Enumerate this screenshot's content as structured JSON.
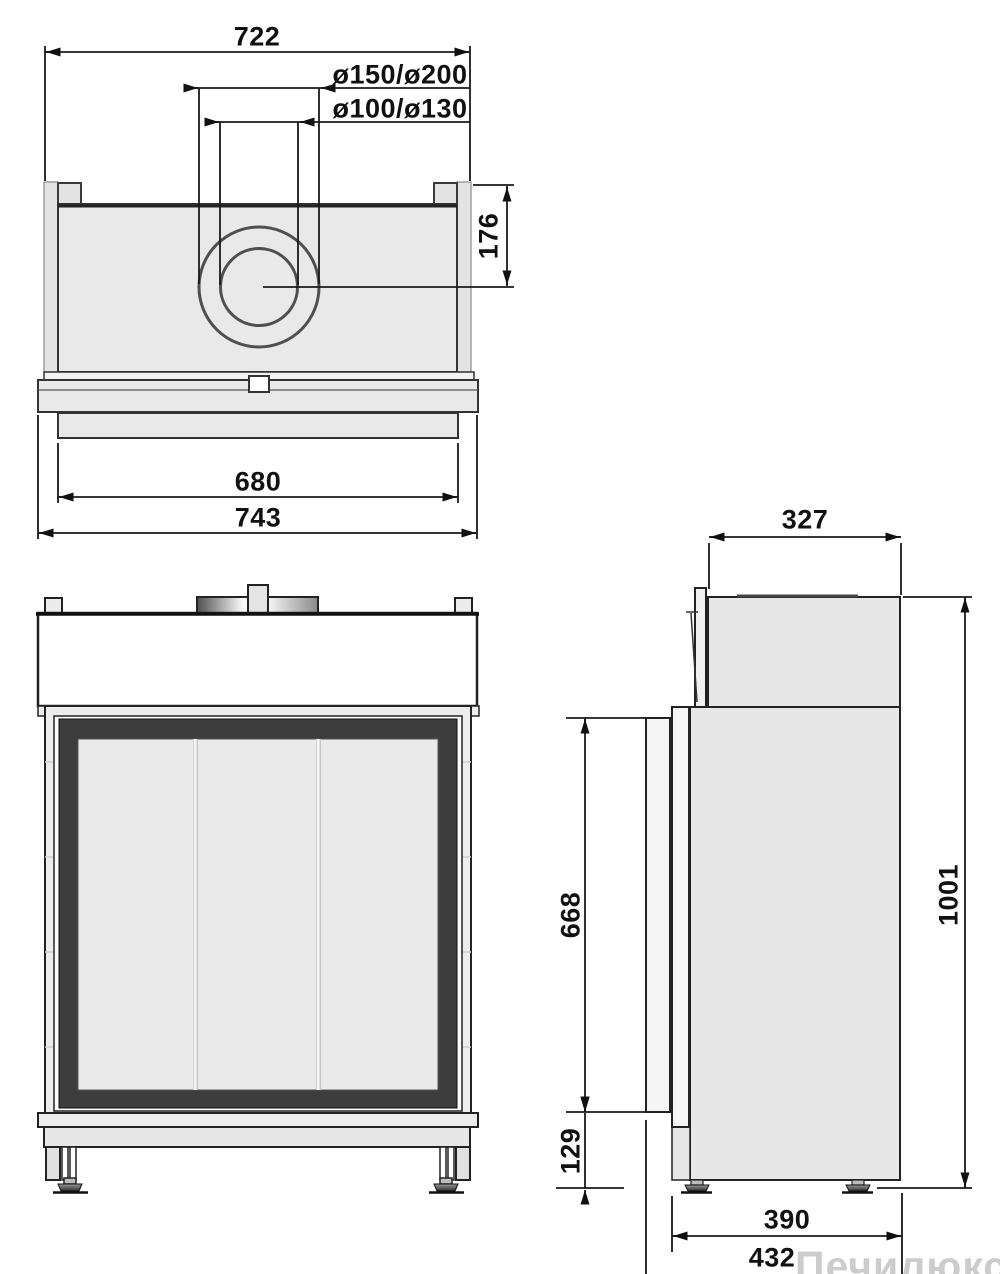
{
  "drawing": {
    "watermark": "Печилюкс.ру",
    "views": {
      "top": {
        "overall_width": "722",
        "flue_outer_diameters": "ø150/ø200",
        "flue_inner_diameters": "ø100/ø130",
        "flue_center_from_back": "176",
        "glass_width": "680",
        "frame_width": "743"
      },
      "side": {
        "top_depth": "327",
        "front_frame_height": "668",
        "base_height": "129",
        "total_height": "1001",
        "body_depth": "390",
        "overall_depth": "432"
      }
    },
    "colors": {
      "line": "#1f1f1f",
      "body_fill": "#e9e9e9",
      "dark_frame": "#3d3d3d",
      "glass": "#eaeaea",
      "watermark": "#c7c7c7"
    }
  }
}
